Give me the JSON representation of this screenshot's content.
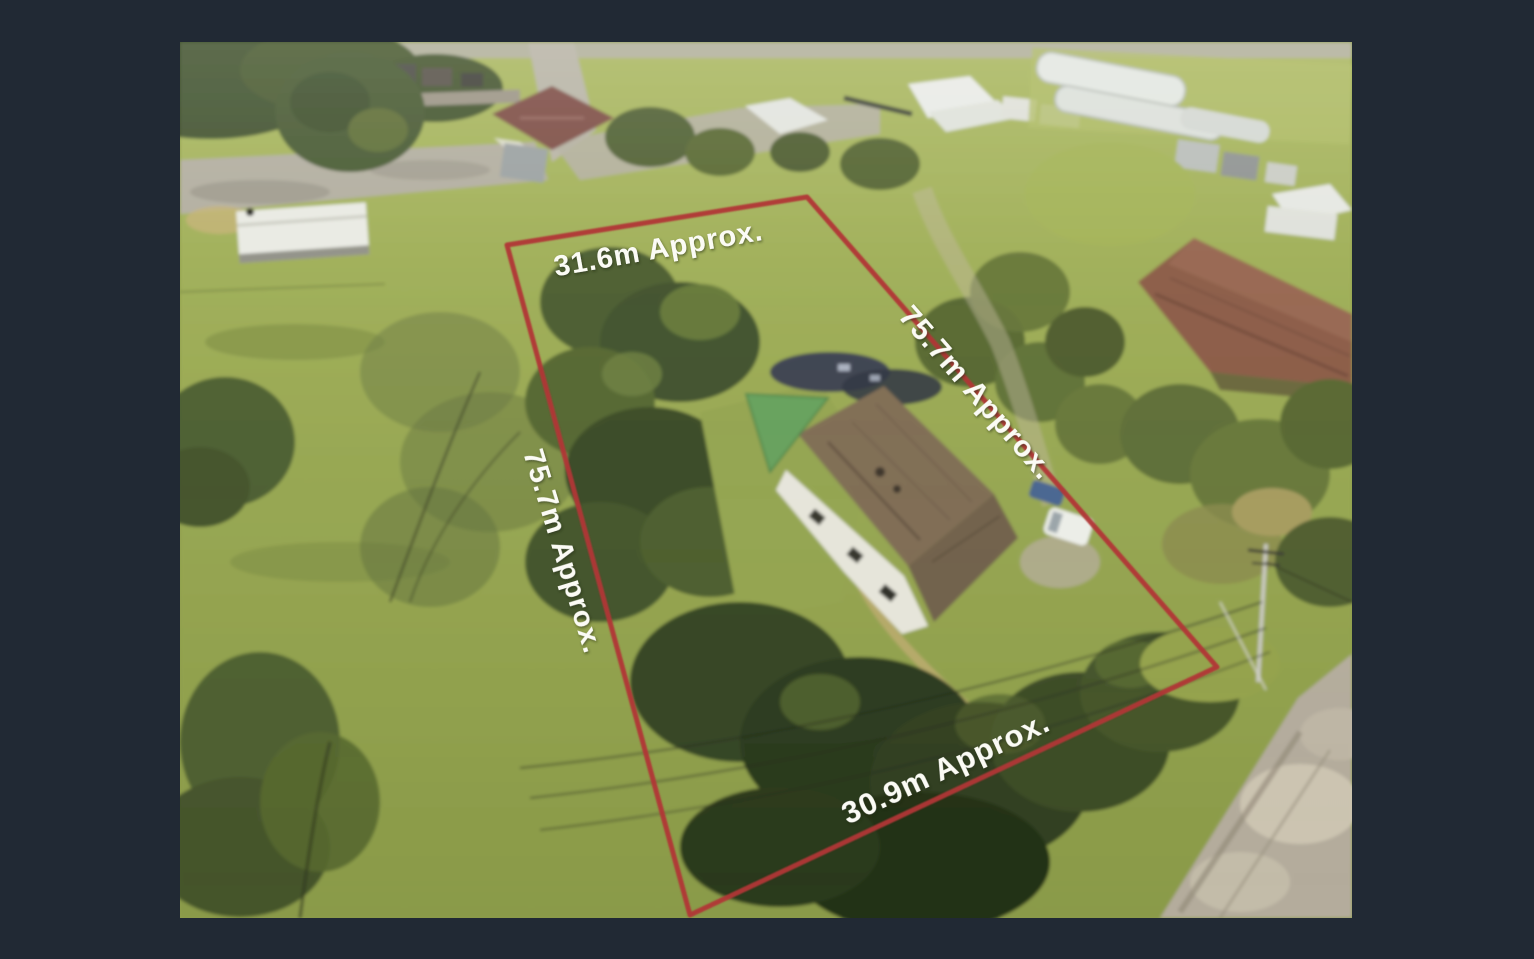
{
  "frame": {
    "background_color": "#212934"
  },
  "photo": {
    "boundary_color": "#b13636",
    "label_color": "#fbfbf5",
    "labels": {
      "top": {
        "text": "31.6m Approx."
      },
      "left": {
        "text": "75.7m Approx."
      },
      "right": {
        "text": "75.7m Approx."
      },
      "bottom": {
        "text": "30.9m Approx."
      }
    }
  }
}
